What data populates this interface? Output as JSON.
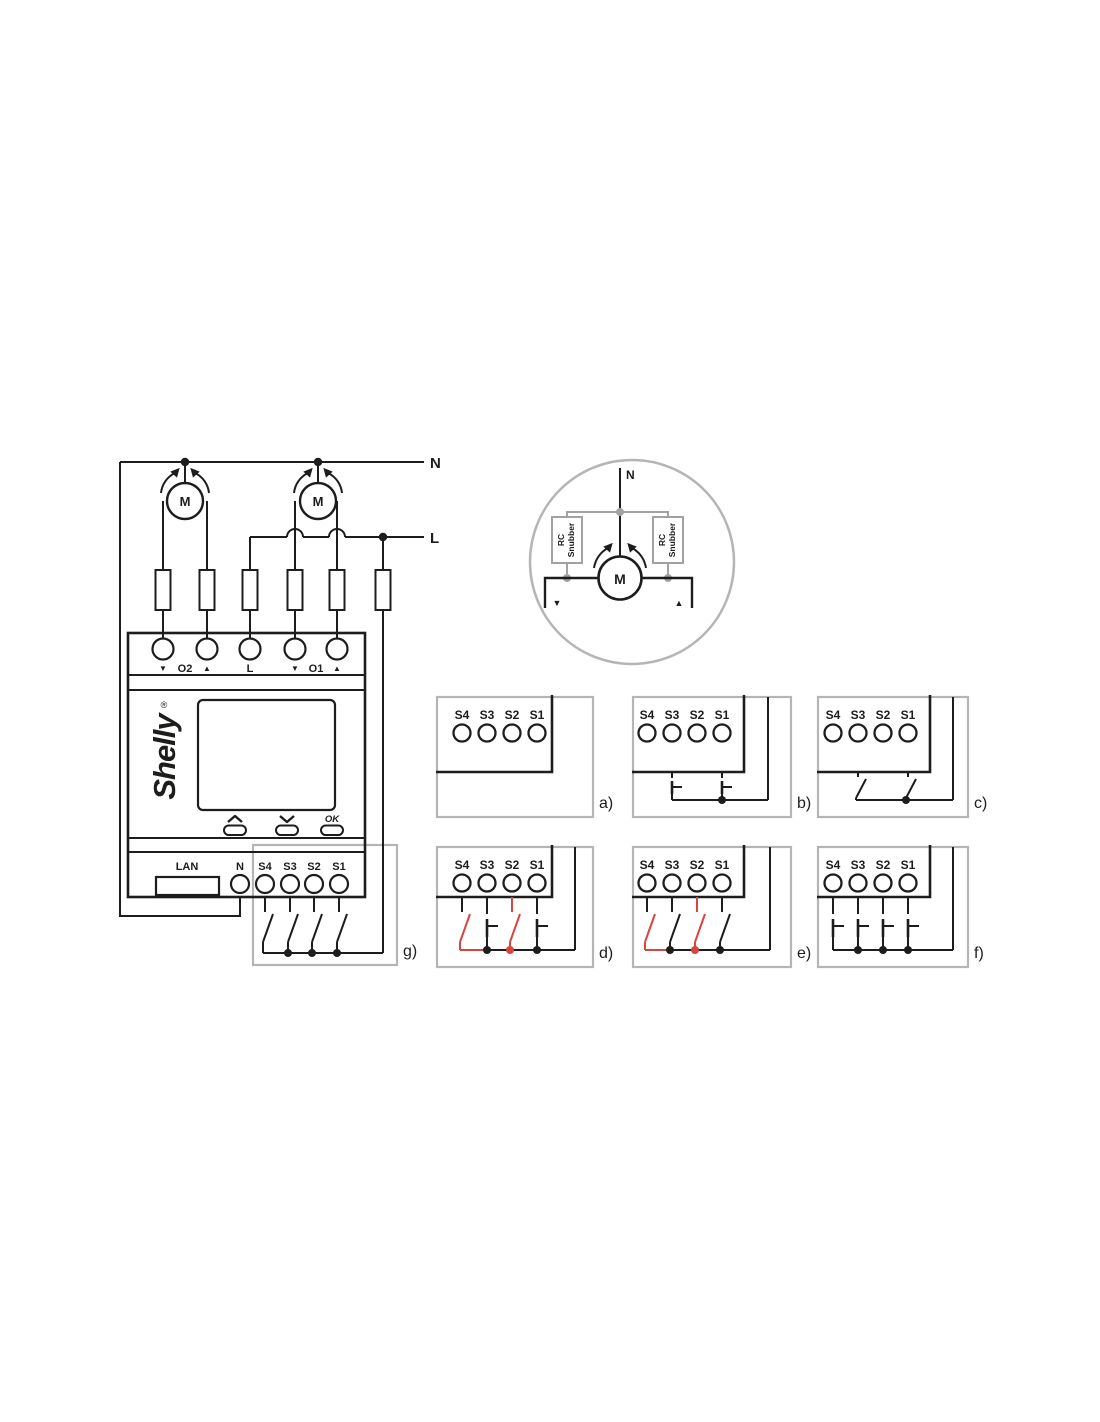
{
  "colors": {
    "black": "#1d1d1b",
    "red": "#d8453e",
    "frame_gray": "#b5b5b5",
    "detail_gray": "#a2a2a1",
    "detail_text_gray": "#9c9c9c"
  },
  "mains": {
    "neutral": "N",
    "live": "L"
  },
  "motor": {
    "label": "M"
  },
  "motor_detail": {
    "neutral": "N",
    "rc": "RC",
    "snubber": "Snubber",
    "down": "▼",
    "up": "▲"
  },
  "device": {
    "brand": "Shelly",
    "trademark": "®",
    "output_terminals": [
      "▼",
      "O2",
      "▲",
      "L",
      "▼",
      "O1",
      "▲"
    ],
    "nav_ok": "OK",
    "lan": "LAN",
    "neutral": "N",
    "switch_terminals": [
      "S4",
      "S3",
      "S2",
      "S1"
    ]
  },
  "panels": [
    {
      "id": "a",
      "label": "a)",
      "terminals": [
        "S4",
        "S3",
        "S2",
        "S1"
      ],
      "inputs": []
    },
    {
      "id": "b",
      "label": "b)",
      "terminals": [
        "S4",
        "S3",
        "S2",
        "S1"
      ],
      "inputs": [
        {
          "terminal": "S3",
          "type": "momentary",
          "color": "black"
        },
        {
          "terminal": "S1",
          "type": "momentary",
          "color": "black"
        }
      ]
    },
    {
      "id": "c",
      "label": "c)",
      "terminals": [
        "S4",
        "S3",
        "S2",
        "S1"
      ],
      "inputs": [
        {
          "terminal": "S3",
          "type": "toggle",
          "color": "black"
        },
        {
          "terminal": "S1",
          "type": "toggle",
          "color": "black"
        }
      ]
    },
    {
      "id": "d",
      "label": "d)",
      "terminals": [
        "S4",
        "S3",
        "S2",
        "S1"
      ],
      "inputs": [
        {
          "terminal": "S4",
          "type": "toggle",
          "color": "red"
        },
        {
          "terminal": "S3",
          "type": "momentary",
          "color": "black"
        },
        {
          "terminal": "S2",
          "type": "toggle",
          "color": "red",
          "stub_color": "red"
        },
        {
          "terminal": "S1",
          "type": "momentary",
          "color": "black"
        }
      ]
    },
    {
      "id": "e",
      "label": "e)",
      "terminals": [
        "S4",
        "S3",
        "S2",
        "S1"
      ],
      "inputs": [
        {
          "terminal": "S4",
          "type": "toggle",
          "color": "red"
        },
        {
          "terminal": "S3",
          "type": "toggle",
          "color": "black"
        },
        {
          "terminal": "S2",
          "type": "toggle",
          "color": "red",
          "stub_color": "red"
        },
        {
          "terminal": "S1",
          "type": "toggle",
          "color": "black"
        }
      ]
    },
    {
      "id": "f",
      "label": "f)",
      "terminals": [
        "S4",
        "S3",
        "S2",
        "S1"
      ],
      "inputs": [
        {
          "terminal": "S4",
          "type": "momentary",
          "color": "black"
        },
        {
          "terminal": "S3",
          "type": "momentary",
          "color": "black"
        },
        {
          "terminal": "S2",
          "type": "momentary",
          "color": "black"
        },
        {
          "terminal": "S1",
          "type": "momentary",
          "color": "black"
        }
      ]
    },
    {
      "id": "g",
      "label": "g)",
      "overlay_on_device": true,
      "terminals": [
        "S4",
        "S3",
        "S2",
        "S1"
      ],
      "inputs": [
        {
          "terminal": "S4",
          "type": "toggle",
          "color": "black"
        },
        {
          "terminal": "S3",
          "type": "toggle",
          "color": "black"
        },
        {
          "terminal": "S2",
          "type": "toggle",
          "color": "black"
        },
        {
          "terminal": "S1",
          "type": "toggle",
          "color": "black"
        }
      ]
    }
  ]
}
